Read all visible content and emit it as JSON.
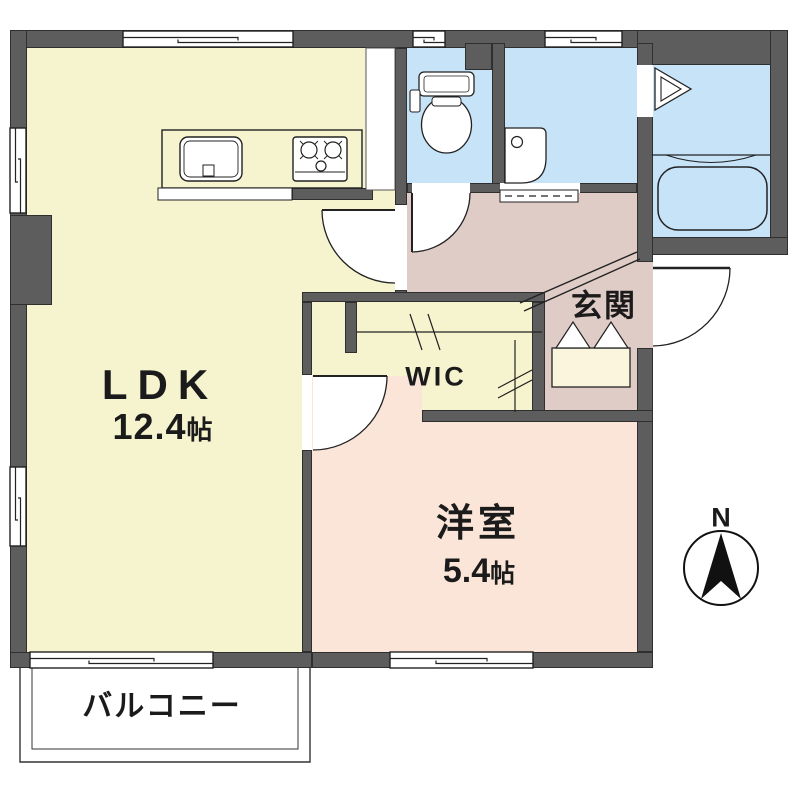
{
  "floorplan": {
    "rooms": {
      "ldk": {
        "label": "LDK",
        "area_value": "12.4",
        "area_unit": "帖"
      },
      "western_room": {
        "label": "洋室",
        "area_value": "5.4",
        "area_unit": "帖"
      },
      "wic": {
        "label": "WIC"
      },
      "entrance": {
        "label": "玄関"
      },
      "balcony": {
        "label": "バルコニー"
      }
    },
    "compass": {
      "north_label": "N"
    },
    "colors": {
      "wall": "#5d5d5d",
      "ldk": "#f6f4cf",
      "western": "#fae5d8",
      "hall": "#e0ccc7",
      "wet": "#c7e3f8",
      "outline": "#222222"
    }
  }
}
